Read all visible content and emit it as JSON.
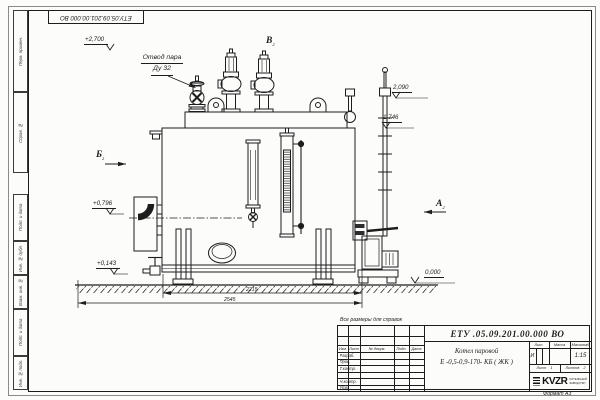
{
  "sheet": {
    "stamp_designation": "ЕТУ.05.09.201.00.000 ВО",
    "reference_note": "Все размеры для справок",
    "format_note": "Формат А3"
  },
  "margin_labels": [
    "Перв. примен.",
    "Справ. №",
    "Подп. и дата",
    "Инв. № дубл.",
    "Взам. инв. №",
    "Подп. и дата",
    "Инв. № подл."
  ],
  "annotations": {
    "steam_outlet_line1": "Отвод пара",
    "steam_outlet_line2": "Ду 32",
    "elev_top": "+2,700",
    "elev_2090": "2,090",
    "elev_1746": "1,746",
    "elev_0796": "+0,796",
    "elev_0143": "+0,143",
    "elev_zero": "0,000",
    "view_a": "А",
    "view_a_sub": "2",
    "view_b": "Б",
    "view_b_sub": "2",
    "view_v": "В",
    "view_v_sub": "2",
    "dim_inner": "2215",
    "dim_outer": "2545"
  },
  "title_block": {
    "designation": "ЕТУ .05.09.201.00.000   ВО",
    "product_name_line1": "Котел паровой",
    "product_name_line2": "Е -0,5-0,9-170- КБ ( ЖК )",
    "rev_header": [
      "Изм.",
      "Лист",
      "№ докум.",
      "Подп.",
      "Дата"
    ],
    "sig_rows": [
      "Разраб.",
      "Пров.",
      "Т.контр.",
      "Н.контр.",
      "Утв."
    ],
    "lit_label": "Лит.",
    "lit_value": "И",
    "mass_label": "Масса",
    "scale_label": "Масштаб",
    "scale_value": "1:15",
    "sheet_label": "Лист",
    "sheet_value": "1",
    "sheets_label": "Листов",
    "sheets_value": "2",
    "logo_text": "KVZR",
    "logo_caption_line1": "КОТЕЛЬНЫЙ",
    "logo_caption_line2": "ЗАВОД РЭП"
  },
  "colors": {
    "line": "#1d1d1d",
    "paper": "#fcfcfa"
  }
}
